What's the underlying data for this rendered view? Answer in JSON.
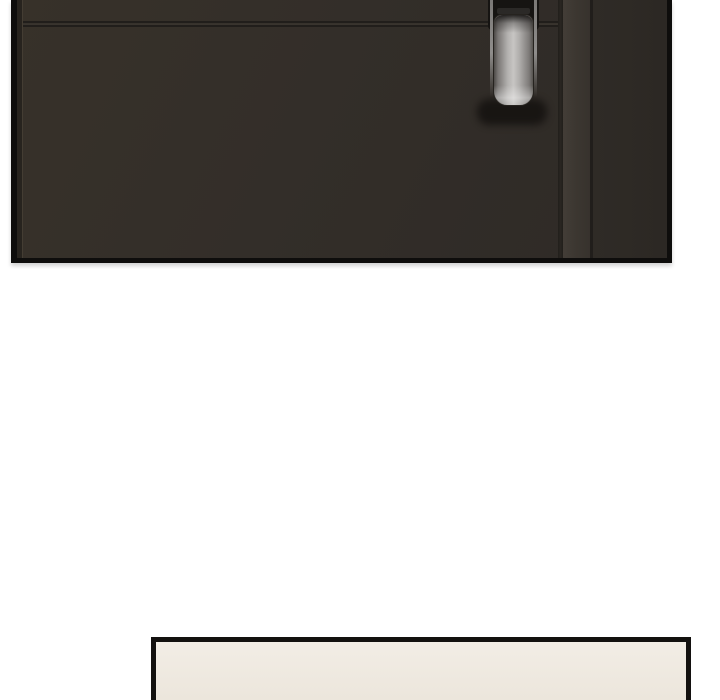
{
  "page": {
    "kind": "comic-strip-page",
    "text_content": "none"
  },
  "panels": {
    "door": {
      "description": "dark brown door with recessed vertical metal pull handle, panel cropped at top edge of image",
      "elements": [
        "door-surface",
        "horizontal-seam",
        "door-edge",
        "frame-band",
        "handle-slot",
        "metal-handle",
        "handle-shadow"
      ]
    },
    "bottom": {
      "description": "empty cream panel, only top sliver visible, cropped at bottom edge of image"
    }
  },
  "colors": {
    "page_bg": "#ffffff",
    "panel_border": "#0e0d0c",
    "door_base_1": "#373129",
    "door_base_2": "#332e29",
    "door_base_3": "#2e2a26",
    "door_left_edge": "#27231e",
    "groove_dark": "#211e1b",
    "groove_light": "#403a33",
    "frame_band": "#3c3731",
    "right_section": "#2f2b26",
    "handle_slot": "#161412",
    "metal_edge": "#7b7977",
    "metal_light": "#c7c5c3",
    "metal_dark": "#4c4946",
    "handle_shadow": "#14110f",
    "cream_1": "#f2ede5",
    "cream_2": "#ece6dc",
    "bottom_border": "#13110f"
  }
}
